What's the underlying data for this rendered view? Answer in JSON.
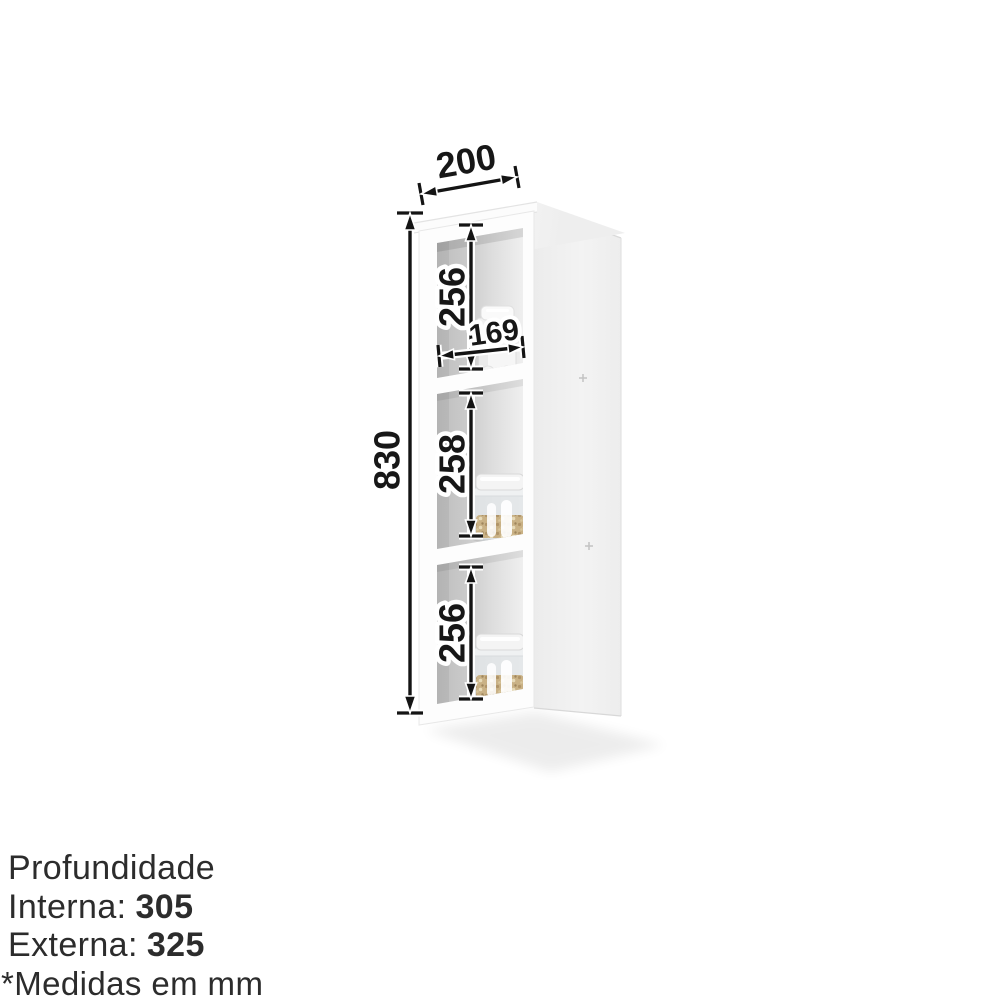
{
  "dimensions": {
    "top_width": "200",
    "total_height": "830",
    "inner_width": "169",
    "compartment_heights": [
      "256",
      "258",
      "256"
    ]
  },
  "footer": {
    "title": "Profundidade",
    "internal_label": "Interna:",
    "internal_value": "305",
    "external_label": "Externa:",
    "external_value": "325",
    "note": "*Medidas em mm"
  },
  "scene": {
    "object": "narrow-wall-cabinet-three-open-shelves",
    "items": [
      "white-ceramic-jar",
      "glass-jar-with-oats",
      "glass-jar-with-oats"
    ]
  },
  "colors": {
    "background": "#ffffff",
    "dimension_ink": "#141414",
    "dimension_halo": "#ffffff",
    "cabinet_white": "#fdfdfd",
    "interior_gray_dark": "#bdbdbd",
    "interior_gray_light": "#efefef",
    "side_panel": "#efefef",
    "oats": "#c9b185",
    "footer_text": "#2c2c2c"
  }
}
